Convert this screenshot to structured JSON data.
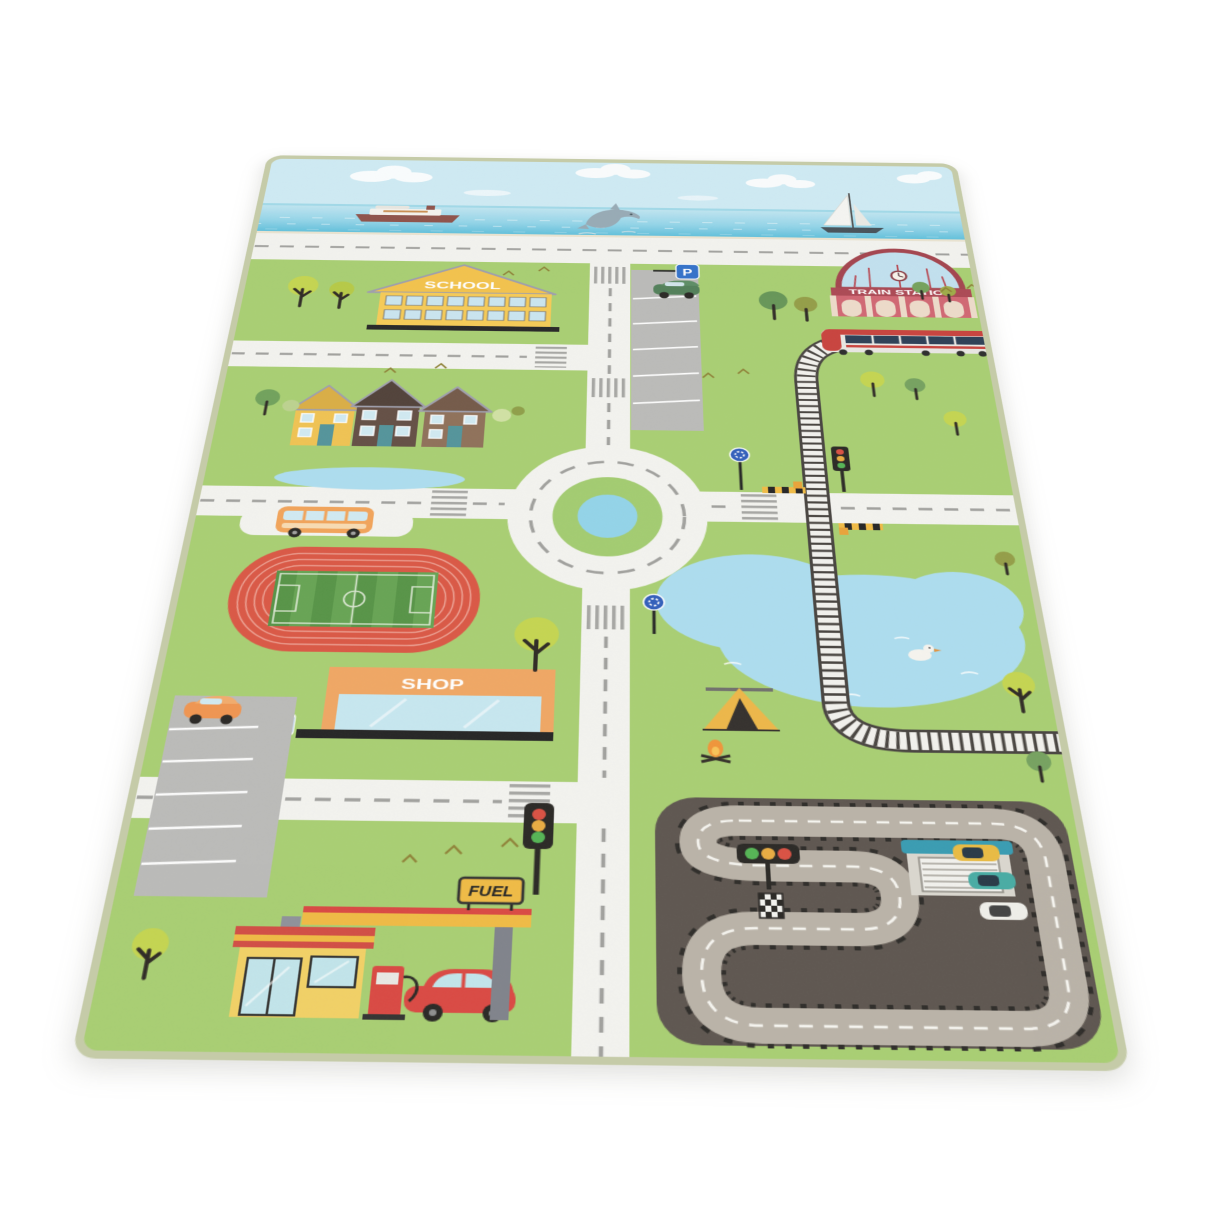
{
  "scene": {
    "description": "Product photo of a children's city-traffic play rug lying in perspective on a white background",
    "background_color": "#ffffff"
  },
  "rug": {
    "labels": {
      "school": "SCHOOL",
      "train_station": "TRAIN STATION",
      "shop": "SHOP",
      "fuel": "FUEL",
      "parking_top": "P",
      "parking_shop": "P"
    },
    "colors": {
      "grass": "#a5cd6c",
      "road_white": "#f3f3ef",
      "road_dash_gray": "#9c9c99",
      "sky_blue": "#cdeaf4",
      "sea_blue": "#6ec8e2",
      "pond_blue": "#a9dcef",
      "racing_asphalt": "#564e47",
      "racing_track_gray": "#b7afa4",
      "stadium_track_red": "#d8503c",
      "school_yellow": "#f4c244",
      "station_red": "#b5434e",
      "shop_orange": "#f0a35c",
      "binding_edge": "#c5cba8"
    },
    "features": [
      "sea with cruise ship, jumping dolphin and sailboat",
      "coastal road",
      "school building",
      "parking lot with green car and P sign",
      "train station with clock and red train",
      "railway line with level crossing and barriers",
      "three houses with small pond",
      "roundabout with pond island",
      "bus in bus bay",
      "athletics stadium with soccer field",
      "shop building with P sign",
      "parking lot with orange car",
      "big duck pond",
      "camping tent with campfire",
      "fuel station with red car at pump",
      "race circuit with garage, start lights, checkered flag and three race cars",
      "traffic lights, roundabout signs, trees and birds"
    ]
  }
}
